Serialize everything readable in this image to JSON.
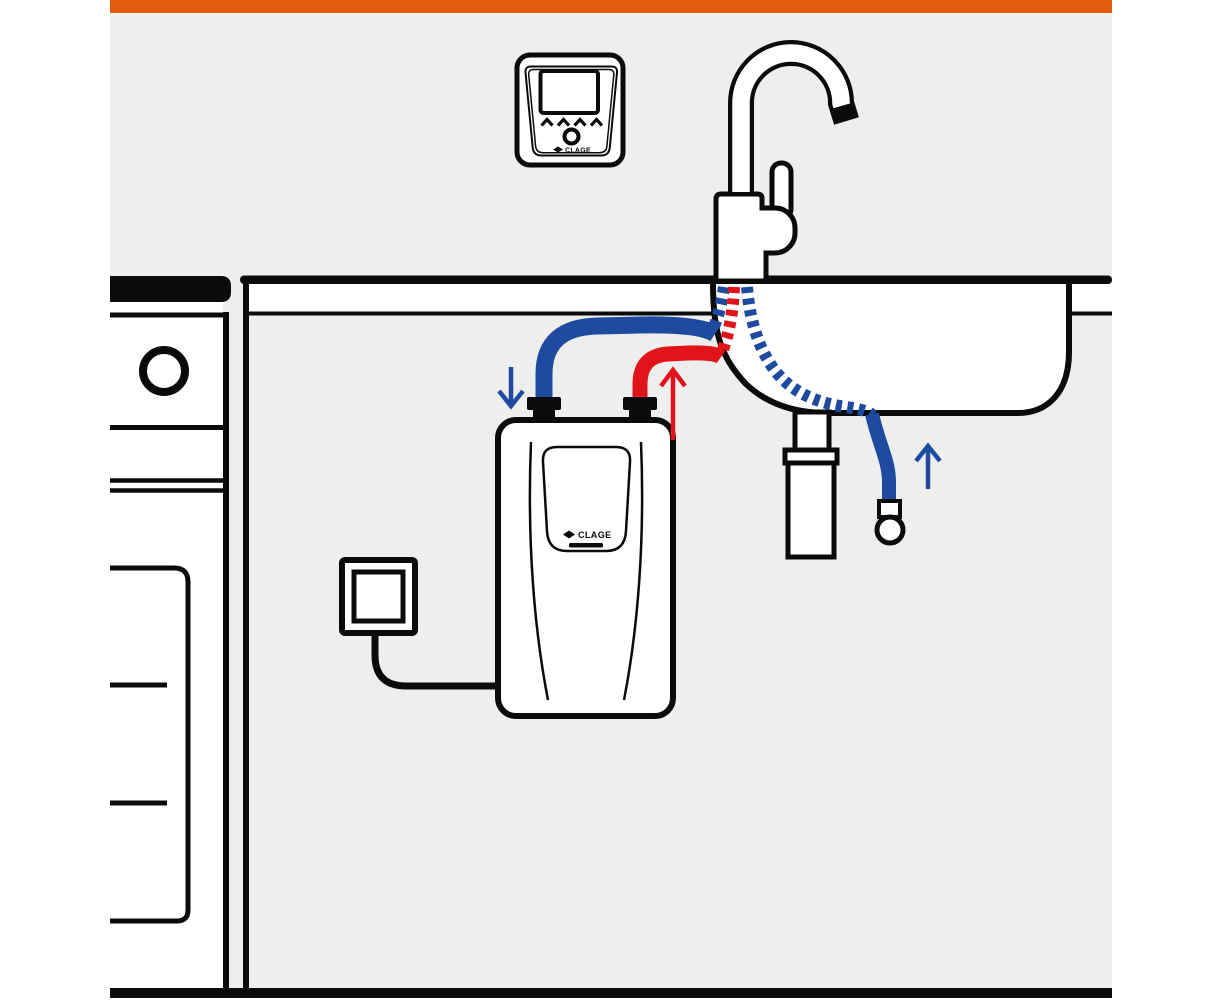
{
  "title": "Under-sink instant water heater installation diagram",
  "colors": {
    "accent_orange": "#E25C0E",
    "background_gray": "#EEEEEC",
    "line_black": "#0B0B0B",
    "cold_blue": "#1E4BA0",
    "hot_red": "#E1141B",
    "white": "#FFFFFF",
    "highlight_strip": "#F7F2EC"
  },
  "wall_panel": {
    "logo": "CLAGE"
  },
  "heater": {
    "logo": "CLAGE"
  },
  "flow_arrows": {
    "cold_inlet_direction": "down",
    "hot_outlet_direction": "up",
    "cold_supply_direction": "up"
  },
  "components": [
    "orange-header-bar",
    "wall-remote-control",
    "kitchen-mixer-faucet",
    "countertop",
    "built-in-appliance",
    "sink-basin",
    "drain-trap",
    "dashed-cold-hose",
    "dashed-hot-hose",
    "cold-water-pipe",
    "hot-water-pipe",
    "under-sink-water-heater",
    "shut-off-valve",
    "power-outlet",
    "power-cable"
  ]
}
